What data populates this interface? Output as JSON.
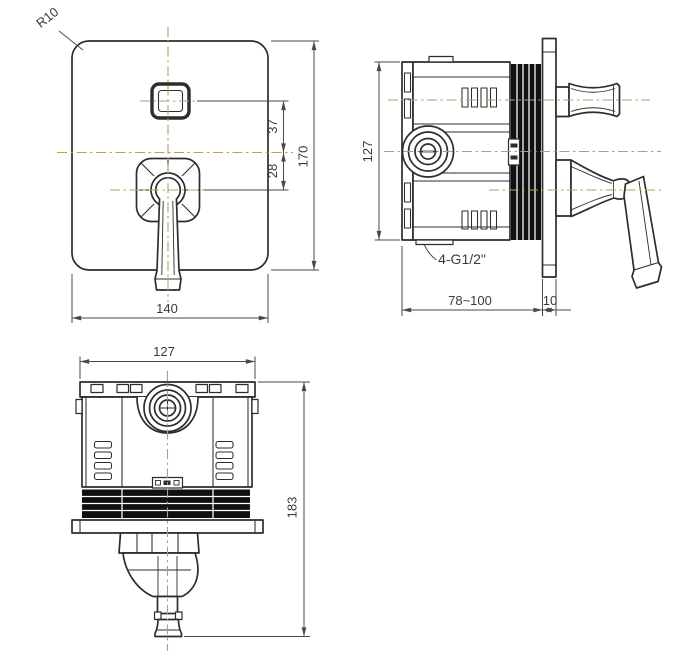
{
  "colors": {
    "outline": "#2d2d2d",
    "centerline": "#b3a06a",
    "dimension": "#4a4a4a",
    "text": "#3a3a3a",
    "hatch": "#101010",
    "background": "#ffffff"
  },
  "views": {
    "front": {
      "labels": {
        "radius": "R10",
        "width": "140",
        "height": "170",
        "offset_upper": "37",
        "offset_lower": "28"
      }
    },
    "side": {
      "labels": {
        "height": "127",
        "depth_range": "78~100",
        "plate_thickness": "10",
        "thread": "4-G1/2\""
      }
    },
    "bottom": {
      "labels": {
        "width": "127",
        "height": "183"
      }
    }
  }
}
